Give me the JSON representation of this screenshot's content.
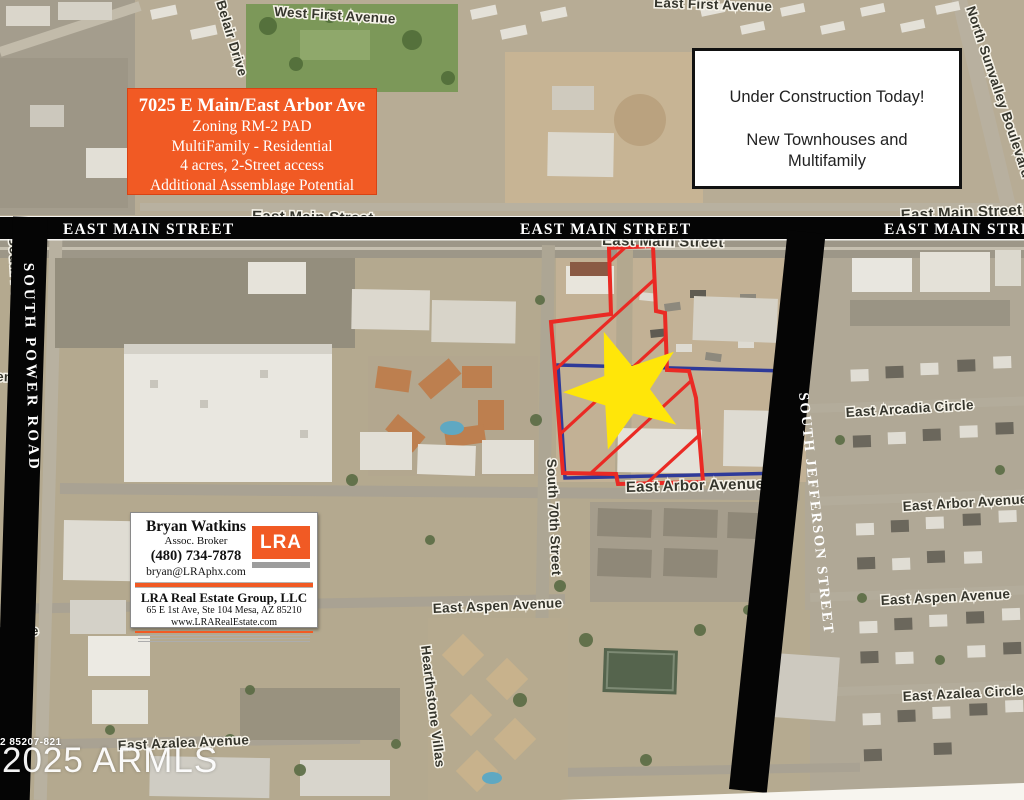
{
  "colors": {
    "accent_orange": "#f15a24",
    "parcel_outline_red": "#ea2a24",
    "parcel_outline_blue": "#2e3a99",
    "star_yellow": "#ffe609",
    "street_bar_black": "#050505"
  },
  "listing_box": {
    "title": "7025 E Main/East Arbor Ave",
    "line1": "Zoning RM-2 PAD",
    "line2": "MultiFamily - Residential",
    "line3": "4 acres, 2-Street access",
    "line4": "Additional Assemblage Potential"
  },
  "construction_box": {
    "line1": "Under Construction Today!",
    "line2": "New Townhouses and",
    "line3": "Multifamily"
  },
  "street_bars": {
    "east_main": "EAST MAIN STREET",
    "south_power": "SOUTH POWER ROAD",
    "south_jefferson": "SOUTH JEFFERSON STREET"
  },
  "map_labels": {
    "west_first": "West First Avenue",
    "belair": "Belair Drive",
    "east_first": "East First Avenue",
    "north_sunvalley": "North Sunvalley Boulevard",
    "east_main": "East Main Street",
    "south_power_small": "South Power",
    "avenue_cut_upper": "enue",
    "avenue_cut_lower": "venue",
    "south_70th": "South 70th Street",
    "east_arbor_center": "East Arbor Avenue",
    "east_arbor_right": "East Arbor Avenue",
    "east_arcadia": "East Arcadia Circle",
    "east_aspen_center": "East Aspen Avenue",
    "east_aspen_right": "East Aspen Avenue",
    "east_azalea_left": "East Azalea Avenue",
    "east_azalea_right": "East Azalea Circle",
    "hearthstone": "Hearthstone Villas"
  },
  "broker_card": {
    "name": "Bryan Watkins",
    "role": "Assoc. Broker",
    "phone": "(480) 734-7878",
    "email": "bryan@LRAphx.com",
    "logo_text": "LRA",
    "company": "LRA Real Estate Group, LLC",
    "address": "65 E 1st Ave, Ste 104   Mesa, AZ  85210",
    "website": "www.LRARealEstate.com"
  },
  "watermark": {
    "mls_number": "2 85207-821",
    "armls": "2025 ARMLS"
  }
}
